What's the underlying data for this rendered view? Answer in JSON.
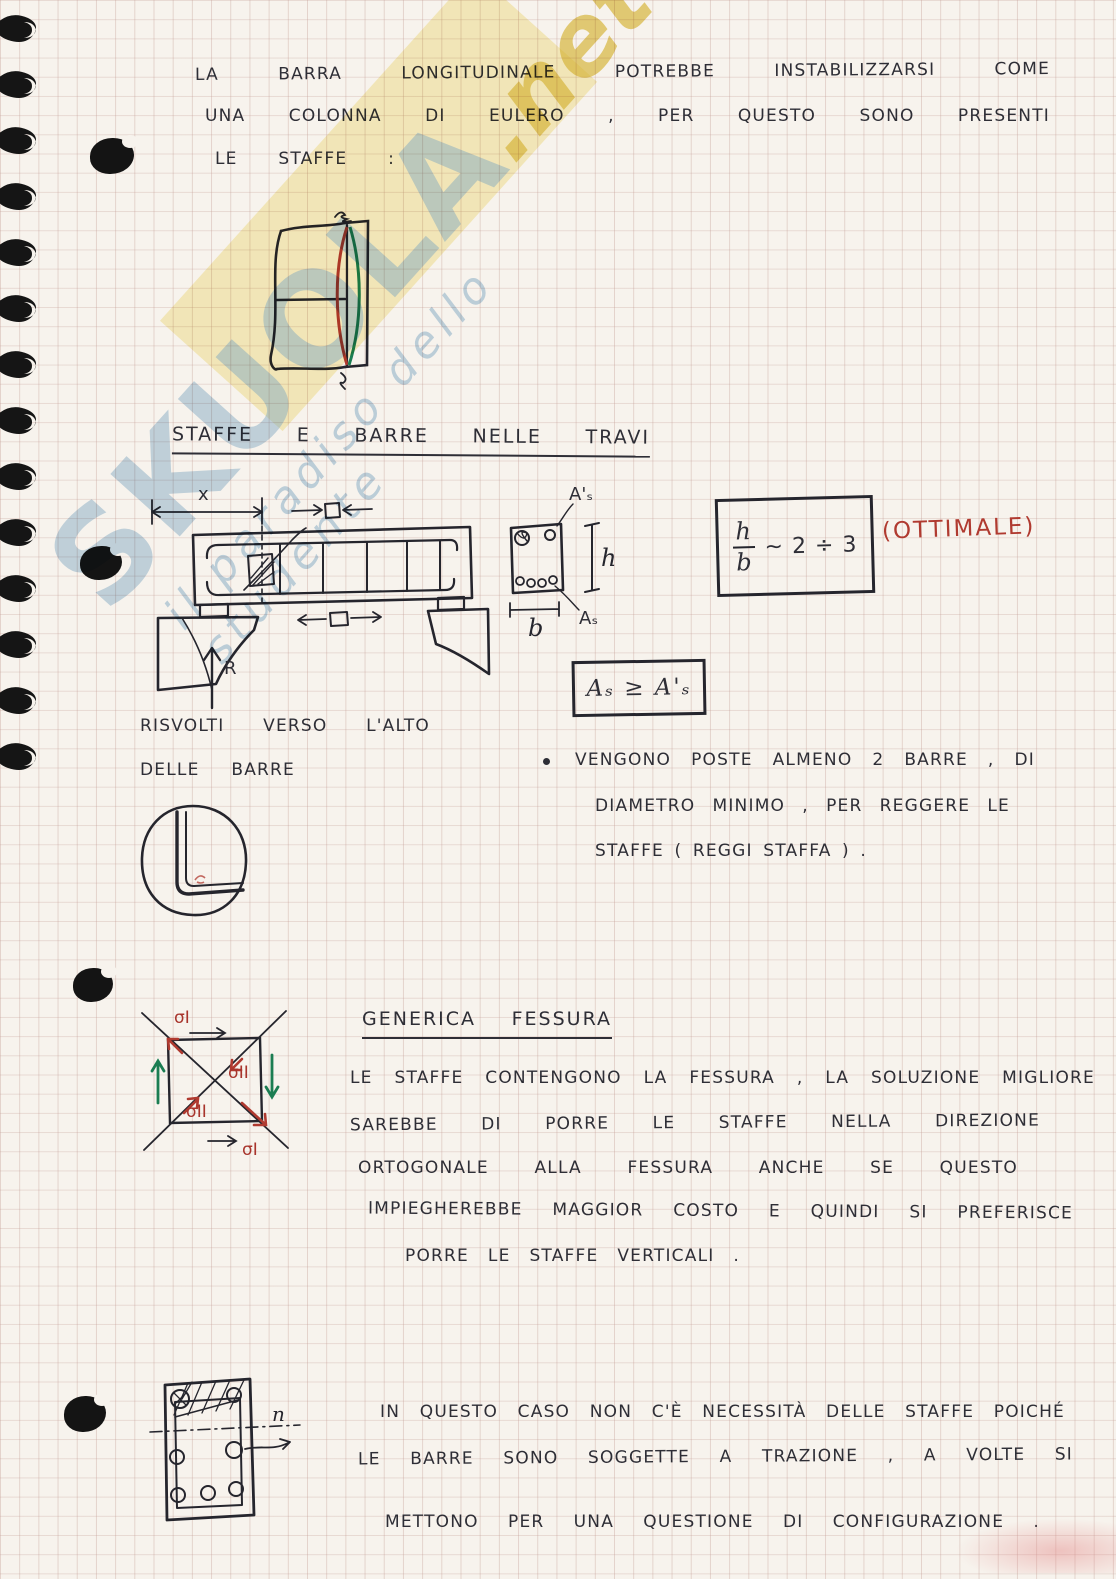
{
  "palette": {
    "paper": "#f7f3ed",
    "ink": "#2e2e36",
    "red_ink": "#b03a30",
    "green_ink": "#1b7d52",
    "watermark_blue": "#7eacce",
    "watermark_band": "#f5e9a2"
  },
  "watermark": {
    "brand": "SKUOLA",
    "brand_suffix": ".net",
    "tagline": "il paradiso dello studente"
  },
  "intro": {
    "line1": "LA BARRA LONGITUDINALE POTREBBE INSTABILIZZARSI COME",
    "line2": "UNA COLONNA DI EULERO , PER QUESTO SONO PRESENTI",
    "line3": "LE STAFFE :"
  },
  "section1": {
    "heading": "STAFFE E BARRE NELLE TRAVI",
    "risvolti_line1": "RISVOLTI VERSO L'ALTO",
    "risvolti_line2": "DELLE BARRE",
    "bullet_line1": "VENGONO POSTE ALMENO 2 BARRE , DI",
    "bullet_line2": "DIAMETRO MINIMO , PER REGGERE LE",
    "bullet_line3": "STAFFE ( REGGI STAFFA ) ."
  },
  "formulas": {
    "hb_numerator": "h",
    "hb_denominator": "b",
    "hb_relation": "~  2 ÷ 3",
    "hb_note": "(OTTIMALE)",
    "as_rule": "Aₛ ≥ A'ₛ"
  },
  "labels": {
    "dim_x": "x",
    "reaction": "R",
    "a_prime": "A'ₛ",
    "height": "h",
    "a_bottom": "Aₛ",
    "base": "b",
    "sigma_1": "σI",
    "sigma_2": "σII",
    "neutral": "n"
  },
  "section2": {
    "heading": "GENERICA FESSURA",
    "line1": "LE STAFFE CONTENGONO LA FESSURA , LA SOLUZIONE MIGLIORE",
    "line2": "SAREBBE DI PORRE LE STAFFE NELLA DIREZIONE",
    "line3": "ORTOGONALE ALLA FESSURA ANCHE SE QUESTO",
    "line4": "IMPIEGHEREBBE MAGGIOR COSTO E QUINDI SI PREFERISCE",
    "line5": "PORRE LE STAFFE VERTICALI ."
  },
  "section3": {
    "line1": "IN QUESTO CASO NON C'È NECESSITÀ DELLE STAFFE POICHÉ",
    "line2": "LE BARRE SONO SOGGETTE A TRAZIONE , A VOLTE SI",
    "line3": "METTONO PER UNA QUESTIONE DI CONFIGURAZIONE ."
  }
}
